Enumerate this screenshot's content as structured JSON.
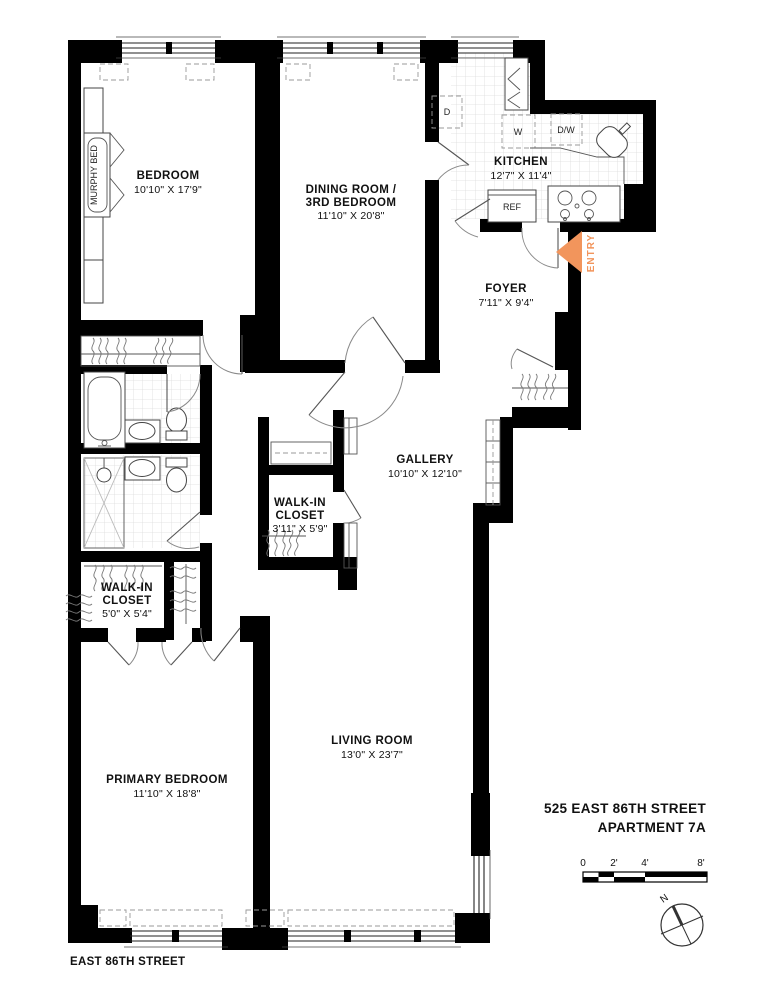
{
  "title": {
    "line1": "525 EAST 86TH STREET",
    "line2": "APARTMENT 7A"
  },
  "street": "EAST 86TH STREET",
  "rooms": {
    "bedroom": {
      "name": "BEDROOM",
      "dims": "10'10\" X 17'9\""
    },
    "dining": {
      "name": "DINING ROOM /",
      "name2": "3RD BEDROOM",
      "dims": "11'10\" X 20'8\""
    },
    "kitchen": {
      "name": "KITCHEN",
      "dims": "12'7\" X 11'4\""
    },
    "foyer": {
      "name": "FOYER",
      "dims": "7'11\" X 9'4\""
    },
    "gallery": {
      "name": "GALLERY",
      "dims": "10'10\" X 12'10\""
    },
    "wic_center": {
      "name": "WALK-IN",
      "name2": "CLOSET",
      "dims": "3'11\" X 5'9\""
    },
    "wic_left": {
      "name": "WALK-IN",
      "name2": "CLOSET",
      "dims": "5'0\" X 5'4\""
    },
    "primary": {
      "name": "PRIMARY BEDROOM",
      "dims": "11'10\" X 18'8\""
    },
    "living": {
      "name": "LIVING ROOM",
      "dims": "13'0\" X 23'7\""
    }
  },
  "fixtures": {
    "murphy_bed": "MURPHY BED",
    "ref": "REF",
    "washer": "W",
    "dryer": "D",
    "dishwasher": "D/W"
  },
  "entry": {
    "label": "ENTRY",
    "color": "#F2955C"
  },
  "scale_bar": {
    "ticks": [
      "0",
      "2'",
      "4'",
      "8'"
    ]
  },
  "compass": {
    "north": "N"
  }
}
